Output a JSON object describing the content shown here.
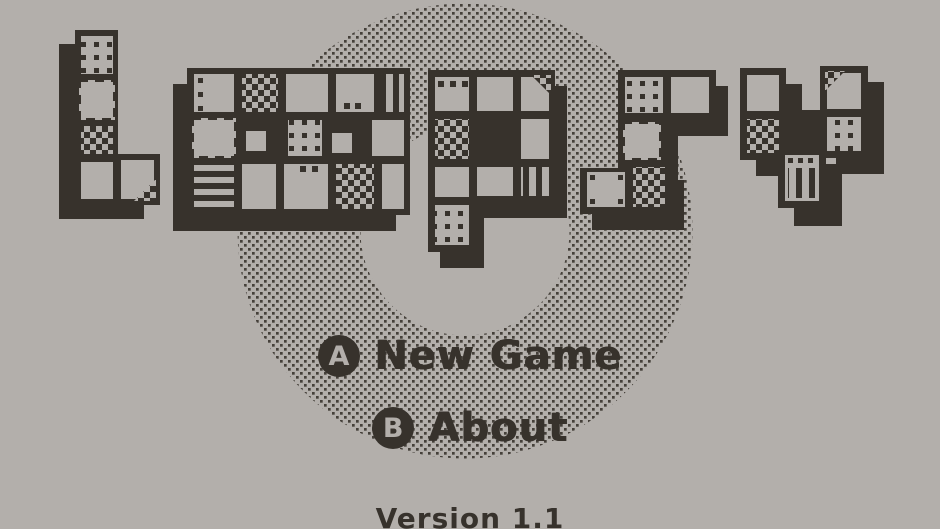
{
  "colors": {
    "background": "#b3afab",
    "ink": "#37322c",
    "dither_dot": "#45403a"
  },
  "title": {
    "text": "Loopsy",
    "letters": [
      "L",
      "o",
      "o",
      "p",
      "s",
      "y"
    ]
  },
  "menu": {
    "items": [
      {
        "button": "A",
        "label": "New Game"
      },
      {
        "button": "B",
        "label": "About"
      }
    ]
  },
  "footer": {
    "version": "Version 1.1"
  }
}
